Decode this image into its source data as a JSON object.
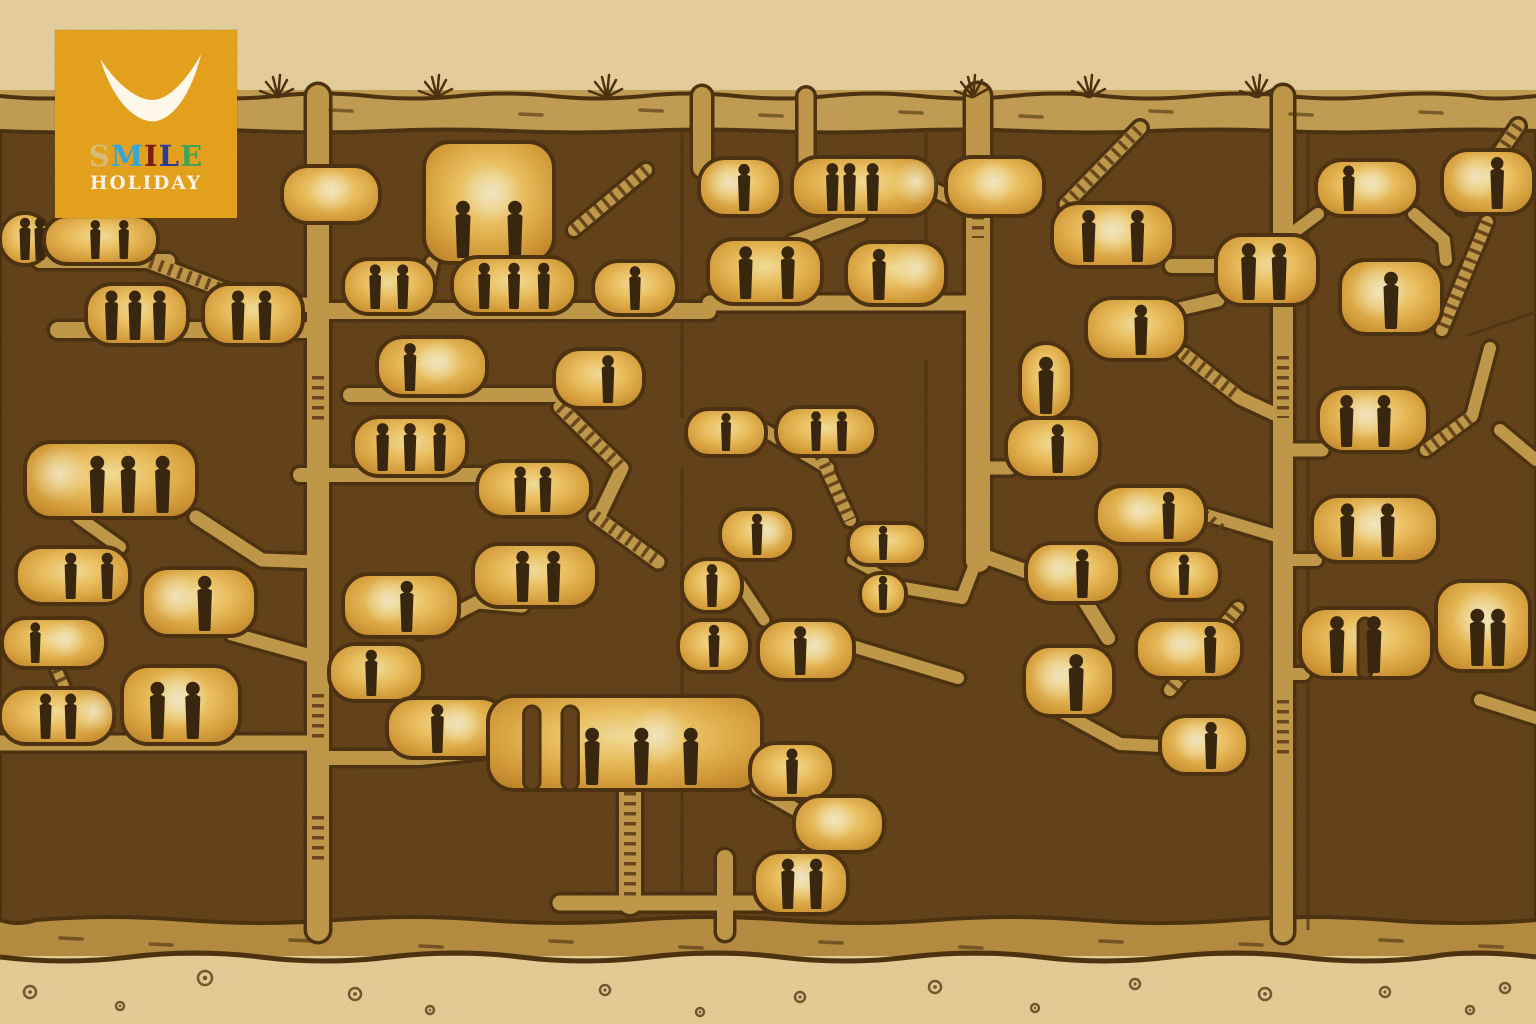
{
  "illustration_subject": "cross-section illustration of an underground cave city: dark rock honeycombed with glowing lamp-lit rooms, connecting tunnels, ladders and stairways, with small human silhouettes standing in the rooms; desert surface with grass tufts on top and pebbly ground below",
  "logo": {
    "brand_top": "SMILE",
    "brand_bottom": "HOLIDAY",
    "bg": "#e2a01d",
    "swoosh_color": "#fdf8ea",
    "holiday_color": "#f7f2e4",
    "letters": [
      {
        "ch": "S",
        "color": "#d6bc74"
      },
      {
        "ch": "M",
        "color": "#33a7d9"
      },
      {
        "ch": "I",
        "color": "#7e1d12"
      },
      {
        "ch": "L",
        "color": "#2a3b9f"
      },
      {
        "ch": "E",
        "color": "#43a457"
      }
    ]
  },
  "palette": {
    "parchment": "#eedaa8",
    "parchment_bottom": "#eed7a0",
    "strata_top": "#c9a257",
    "strata_bottom": "#b98e41",
    "rock": "#5e3c16",
    "outline": "#452a0c",
    "tunnel": "#c79d4b",
    "stair": "#5a3715",
    "glow_core": "#ffeaa6",
    "glow_mid": "#f7ca64",
    "glow_deep": "#dfa43c",
    "glow_edge": "#c5882a",
    "lamp": "#fff6d2",
    "figure": "#2e1d09"
  },
  "scene": {
    "rooms": [
      {
        "x": 0,
        "y": 213,
        "w": 50,
        "h": 52,
        "figs": [
          0.5,
          0.8
        ]
      },
      {
        "x": 44,
        "y": 216,
        "w": 114,
        "h": 48,
        "figs": [
          0.45,
          0.7
        ]
      },
      {
        "x": 86,
        "y": 284,
        "w": 102,
        "h": 61,
        "figs": [
          0.25,
          0.48,
          0.72
        ]
      },
      {
        "x": 203,
        "y": 284,
        "w": 100,
        "h": 61,
        "figs": [
          0.35,
          0.62
        ]
      },
      {
        "x": 25,
        "y": 442,
        "w": 172,
        "h": 76,
        "figs": [
          0.42,
          0.6,
          0.8
        ],
        "lamp": 0.2
      },
      {
        "x": 16,
        "y": 547,
        "w": 114,
        "h": 57,
        "figs": [
          0.48,
          0.8
        ]
      },
      {
        "x": 142,
        "y": 568,
        "w": 114,
        "h": 68,
        "figs": [
          0.55
        ],
        "lamp": 0.3
      },
      {
        "x": 2,
        "y": 618,
        "w": 104,
        "h": 50,
        "figs": [
          0.32
        ],
        "lamp": 0.62
      },
      {
        "x": 0,
        "y": 688,
        "w": 114,
        "h": 56,
        "figs": [
          0.4,
          0.62
        ],
        "lamp": 0.82
      },
      {
        "x": 122,
        "y": 666,
        "w": 118,
        "h": 78,
        "figs": [
          0.3,
          0.6
        ],
        "lamp": 0.48
      },
      {
        "x": 282,
        "y": 166,
        "w": 98,
        "h": 57,
        "figs": [],
        "lamp": 0.5
      },
      {
        "x": 424,
        "y": 142,
        "w": 130,
        "h": 121,
        "figs": [
          0.3,
          0.7
        ],
        "lamp": 0.52
      },
      {
        "x": 343,
        "y": 259,
        "w": 92,
        "h": 55,
        "figs": [
          0.35,
          0.65
        ]
      },
      {
        "x": 452,
        "y": 257,
        "w": 124,
        "h": 57,
        "figs": [
          0.26,
          0.5,
          0.74
        ]
      },
      {
        "x": 593,
        "y": 261,
        "w": 84,
        "h": 54,
        "figs": [
          0.5
        ]
      },
      {
        "x": 377,
        "y": 337,
        "w": 110,
        "h": 59,
        "figs": [
          0.3
        ],
        "lamp": 0.56
      },
      {
        "x": 554,
        "y": 349,
        "w": 90,
        "h": 59,
        "figs": [
          0.6
        ]
      },
      {
        "x": 353,
        "y": 417,
        "w": 114,
        "h": 59,
        "figs": [
          0.26,
          0.5,
          0.76
        ]
      },
      {
        "x": 477,
        "y": 461,
        "w": 114,
        "h": 56,
        "figs": [
          0.38,
          0.6
        ]
      },
      {
        "x": 343,
        "y": 574,
        "w": 116,
        "h": 63,
        "figs": [
          0.55
        ],
        "lamp": 0.38
      },
      {
        "x": 473,
        "y": 544,
        "w": 124,
        "h": 63,
        "figs": [
          0.4,
          0.65
        ]
      },
      {
        "x": 329,
        "y": 644,
        "w": 94,
        "h": 57,
        "figs": [
          0.45
        ]
      },
      {
        "x": 387,
        "y": 698,
        "w": 120,
        "h": 60,
        "figs": [
          0.42
        ],
        "lamp": 0.6
      },
      {
        "x": 699,
        "y": 158,
        "w": 82,
        "h": 58,
        "figs": [
          0.55
        ],
        "lamp": 0.35
      },
      {
        "x": 792,
        "y": 157,
        "w": 144,
        "h": 59,
        "figs": [
          0.28,
          0.4,
          0.56
        ],
        "lamp": 0.86
      },
      {
        "x": 946,
        "y": 157,
        "w": 98,
        "h": 59,
        "figs": [],
        "lamp": 0.48
      },
      {
        "x": 708,
        "y": 239,
        "w": 114,
        "h": 65,
        "figs": [
          0.33,
          0.7
        ]
      },
      {
        "x": 846,
        "y": 242,
        "w": 100,
        "h": 63,
        "figs": [
          0.33
        ],
        "lamp": 0.7
      },
      {
        "x": 686,
        "y": 409,
        "w": 80,
        "h": 47,
        "figs": [
          0.5
        ]
      },
      {
        "x": 776,
        "y": 407,
        "w": 100,
        "h": 49,
        "figs": [
          0.4,
          0.66
        ]
      },
      {
        "x": 720,
        "y": 509,
        "w": 74,
        "h": 51,
        "figs": [
          0.5
        ],
        "lamp": 0.64
      },
      {
        "x": 848,
        "y": 523,
        "w": 78,
        "h": 42,
        "figs": [
          0.45
        ]
      },
      {
        "x": 682,
        "y": 559,
        "w": 60,
        "h": 53,
        "figs": [
          0.5
        ]
      },
      {
        "x": 860,
        "y": 573,
        "w": 46,
        "h": 42,
        "figs": [
          0.5
        ]
      },
      {
        "x": 678,
        "y": 620,
        "w": 72,
        "h": 52,
        "figs": [
          0.5
        ]
      },
      {
        "x": 758,
        "y": 620,
        "w": 96,
        "h": 60,
        "figs": [
          0.44
        ],
        "lamp": 0.6
      },
      {
        "x": 488,
        "y": 696,
        "w": 274,
        "h": 94,
        "figs": [
          0.38,
          0.56,
          0.74
        ],
        "lamp": 0.62,
        "arches": [
          0.13,
          0.27
        ]
      },
      {
        "x": 750,
        "y": 743,
        "w": 84,
        "h": 56,
        "figs": [
          0.5
        ]
      },
      {
        "x": 794,
        "y": 796,
        "w": 90,
        "h": 56,
        "figs": [],
        "lamp": 0.44
      },
      {
        "x": 754,
        "y": 852,
        "w": 94,
        "h": 62,
        "figs": [
          0.36,
          0.66
        ],
        "lamp": 0.5
      },
      {
        "x": 1052,
        "y": 203,
        "w": 122,
        "h": 64,
        "figs": [
          0.3,
          0.7
        ],
        "lamp": 0.5
      },
      {
        "x": 1086,
        "y": 298,
        "w": 100,
        "h": 62,
        "figs": [
          0.55
        ]
      },
      {
        "x": 1020,
        "y": 343,
        "w": 52,
        "h": 76,
        "figs": [
          0.5
        ]
      },
      {
        "x": 1216,
        "y": 235,
        "w": 102,
        "h": 70,
        "figs": [
          0.32,
          0.62
        ]
      },
      {
        "x": 1340,
        "y": 260,
        "w": 102,
        "h": 74,
        "figs": [
          0.5
        ],
        "lamp": 0.38
      },
      {
        "x": 1006,
        "y": 418,
        "w": 94,
        "h": 60,
        "figs": [
          0.55
        ]
      },
      {
        "x": 1096,
        "y": 486,
        "w": 110,
        "h": 58,
        "figs": [
          0.66
        ],
        "lamp": 0.38
      },
      {
        "x": 1026,
        "y": 543,
        "w": 94,
        "h": 60,
        "figs": [
          0.6
        ],
        "lamp": 0.33
      },
      {
        "x": 1148,
        "y": 550,
        "w": 72,
        "h": 50,
        "figs": [
          0.5
        ]
      },
      {
        "x": 1136,
        "y": 620,
        "w": 106,
        "h": 58,
        "figs": [
          0.7
        ],
        "lamp": 0.42
      },
      {
        "x": 1024,
        "y": 646,
        "w": 90,
        "h": 70,
        "figs": [
          0.58
        ],
        "lamp": 0.38
      },
      {
        "x": 1160,
        "y": 716,
        "w": 88,
        "h": 58,
        "figs": [
          0.58
        ],
        "lamp": 0.4
      },
      {
        "x": 1316,
        "y": 160,
        "w": 102,
        "h": 56,
        "figs": [
          0.32
        ],
        "lamp": 0.55
      },
      {
        "x": 1442,
        "y": 150,
        "w": 92,
        "h": 64,
        "figs": [
          0.6
        ],
        "lamp": 0.36
      },
      {
        "x": 1318,
        "y": 388,
        "w": 110,
        "h": 64,
        "figs": [
          0.26,
          0.6
        ],
        "lamp": 0.42
      },
      {
        "x": 1312,
        "y": 496,
        "w": 126,
        "h": 66,
        "figs": [
          0.28,
          0.6
        ],
        "lamp": 0.5
      },
      {
        "x": 1300,
        "y": 608,
        "w": 132,
        "h": 70,
        "figs": [
          0.28,
          0.56
        ],
        "arches": [
          0.44
        ]
      },
      {
        "x": 1436,
        "y": 581,
        "w": 94,
        "h": 90,
        "figs": [
          0.44,
          0.66
        ],
        "lamp": 0.5
      }
    ],
    "tunnels": [
      {
        "d": "M318,96 V930",
        "w": 22
      },
      {
        "d": "M702,96 V168",
        "w": 18
      },
      {
        "d": "M806,96 V160",
        "w": 15
      },
      {
        "d": "M978,96 V560",
        "w": 24
      },
      {
        "d": "M1283,96 V932",
        "w": 20
      },
      {
        "d": "M725,858 V932",
        "w": 16
      },
      {
        "d": "M40,261 H168",
        "w": 14
      },
      {
        "d": "M150,262 L250,300 L320,306",
        "w": 14
      },
      {
        "d": "M58,330 H318",
        "w": 16
      },
      {
        "d": "M318,311 H708",
        "w": 16
      },
      {
        "d": "M350,395 H600",
        "w": 14
      },
      {
        "d": "M300,475 H480",
        "w": 14
      },
      {
        "d": "M560,407 L622,468 L600,514",
        "w": 13
      },
      {
        "d": "M595,516 L658,562",
        "w": 13
      },
      {
        "d": "M420,632 L478,602 L522,606",
        "w": 13
      },
      {
        "d": "M78,517 L120,547",
        "w": 12
      },
      {
        "d": "M196,517 L262,560 L318,562",
        "w": 13
      },
      {
        "d": "M232,634 L318,658",
        "w": 13
      },
      {
        "d": "M0,743 H318",
        "w": 15
      },
      {
        "d": "M318,758 L420,758 L490,750",
        "w": 14
      },
      {
        "d": "M630,788 V903",
        "w": 22
      },
      {
        "d": "M560,903 H766",
        "w": 15
      },
      {
        "d": "M758,788 L800,812",
        "w": 13
      },
      {
        "d": "M842,828 L796,862",
        "w": 13
      },
      {
        "d": "M710,303 H978",
        "w": 15
      },
      {
        "d": "M860,216 L792,242",
        "w": 12
      },
      {
        "d": "M934,190 L978,212",
        "w": 13
      },
      {
        "d": "M764,430 L828,468",
        "w": 12
      },
      {
        "d": "M820,455 L850,520",
        "w": 12
      },
      {
        "d": "M740,584 L764,620",
        "w": 11
      },
      {
        "d": "M852,560 L882,576",
        "w": 10
      },
      {
        "d": "M904,588 L962,598 L978,556",
        "w": 12
      },
      {
        "d": "M852,646 L958,678",
        "w": 12
      },
      {
        "d": "M978,468 H1010",
        "w": 13
      },
      {
        "d": "M978,554 L1078,590 L1108,638",
        "w": 14
      },
      {
        "d": "M1058,710 L1120,744 L1162,746",
        "w": 12
      },
      {
        "d": "M1172,266 H1283",
        "w": 14
      },
      {
        "d": "M1098,328 L1218,300",
        "w": 13
      },
      {
        "d": "M1184,354 L1240,398 L1283,418",
        "w": 13
      },
      {
        "d": "M1203,514 L1283,538",
        "w": 12
      },
      {
        "d": "M1283,450 H1322",
        "w": 13
      },
      {
        "d": "M1283,560 H1316",
        "w": 12
      },
      {
        "d": "M1283,674 H1304",
        "w": 12
      },
      {
        "d": "M1426,450 L1472,416 L1490,348",
        "w": 12
      },
      {
        "d": "M1487,222 L1442,330",
        "w": 12
      },
      {
        "d": "M1518,126 L1462,208",
        "w": 13
      },
      {
        "d": "M1066,204 L1140,128",
        "w": 13
      },
      {
        "d": "M1238,608 L1170,690",
        "w": 12
      },
      {
        "d": "M1318,214 L1283,240",
        "w": 12
      },
      {
        "d": "M1414,214 L1444,240 L1446,260",
        "w": 12
      },
      {
        "d": "M52,660 L66,690",
        "w": 10
      },
      {
        "d": "M646,170 L574,230",
        "w": 12
      },
      {
        "d": "M424,304 L432,262",
        "w": 12
      },
      {
        "d": "M1500,430 L1536,460",
        "w": 12
      },
      {
        "d": "M1480,700 L1536,718",
        "w": 12
      }
    ],
    "stairs": [
      "M1066,204 L1140,128",
      "M1518,126 L1462,208",
      "M1487,222 L1442,330",
      "M1426,450 L1472,416",
      "M1238,608 L1170,690",
      "M820,455 L850,520",
      "M630,792 V900",
      "M646,170 L574,230",
      "M595,516 L656,560",
      "M318,694 V738",
      "M318,816 V864",
      "M318,376 V420",
      "M150,262 L250,300",
      "M978,176 V238",
      "M1283,356 V418",
      "M1283,700 V760",
      "M52,660 L66,690",
      "M1203,514 L1246,552",
      "M560,407 L620,466",
      "M1184,354 L1238,396"
    ],
    "cracks": [
      "M682,132 V418",
      "M682,468 V900",
      "M926,132 V300",
      "M926,360 V560",
      "M1308,132 V930",
      "M1466,336 L1536,312",
      "M60,134 L96,224"
    ],
    "grass": [
      278,
      437,
      607,
      973,
      1090,
      1258
    ],
    "dashes_top": [
      [
        70,
        112
      ],
      [
        180,
        116
      ],
      [
        330,
        110
      ],
      [
        520,
        114
      ],
      [
        640,
        110
      ],
      [
        760,
        115
      ],
      [
        900,
        112
      ],
      [
        1020,
        116
      ],
      [
        1150,
        111
      ],
      [
        1290,
        114
      ],
      [
        1420,
        112
      ]
    ],
    "dashes_bottom": [
      [
        60,
        938
      ],
      [
        150,
        944
      ],
      [
        290,
        940
      ],
      [
        420,
        946
      ],
      [
        550,
        941
      ],
      [
        680,
        947
      ],
      [
        820,
        942
      ],
      [
        960,
        947
      ],
      [
        1100,
        941
      ],
      [
        1240,
        944
      ],
      [
        1380,
        940
      ],
      [
        1480,
        946
      ]
    ],
    "pebbles": [
      [
        30,
        992,
        6
      ],
      [
        120,
        1006,
        4
      ],
      [
        205,
        978,
        7
      ],
      [
        355,
        994,
        6
      ],
      [
        430,
        1010,
        4
      ],
      [
        605,
        990,
        5
      ],
      [
        700,
        1012,
        4
      ],
      [
        800,
        997,
        5
      ],
      [
        935,
        987,
        6
      ],
      [
        1035,
        1008,
        4
      ],
      [
        1135,
        984,
        5
      ],
      [
        1265,
        994,
        6
      ],
      [
        1385,
        992,
        5
      ],
      [
        1470,
        1010,
        4
      ],
      [
        1505,
        988,
        5
      ]
    ]
  }
}
